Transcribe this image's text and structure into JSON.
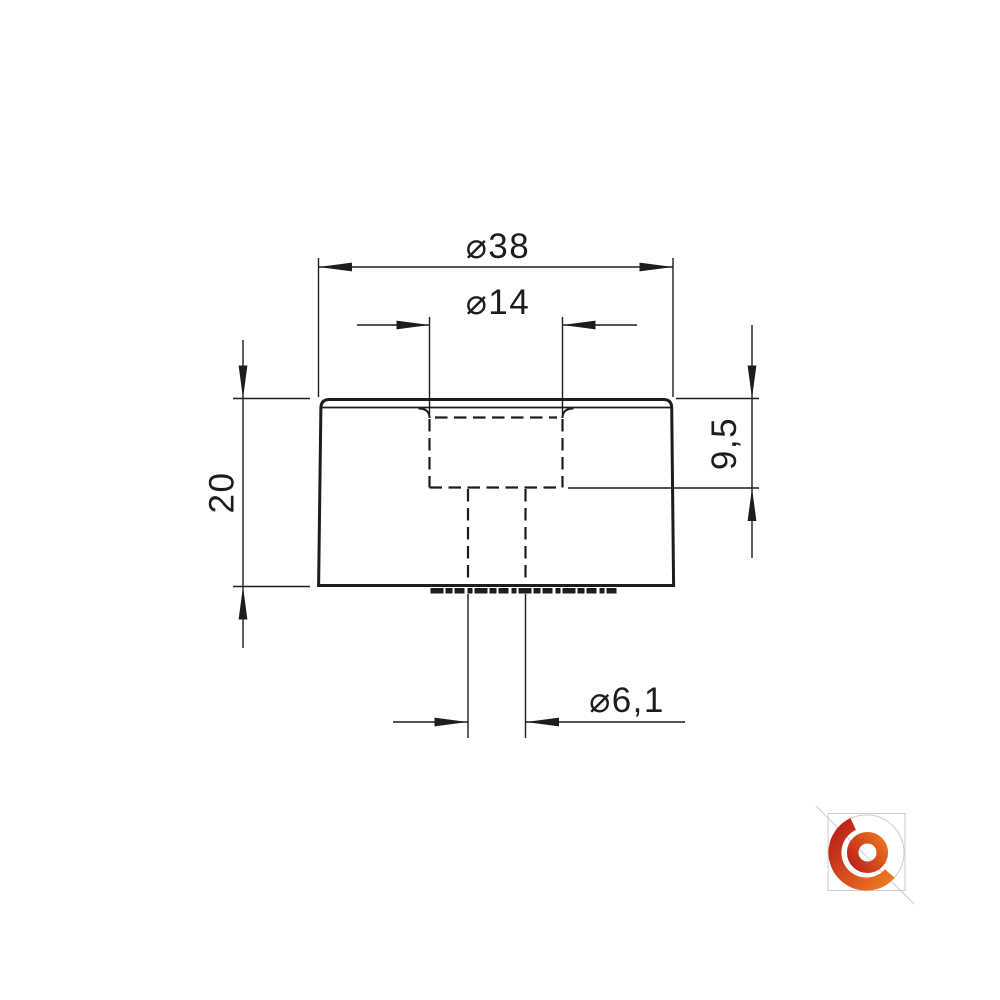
{
  "drawing": {
    "line_color": "#1d1d1d",
    "dim_outer_diameter": "⌀38",
    "dim_insert_diameter": "⌀14",
    "dim_height": "20",
    "dim_insert_depth": "9,5",
    "dim_hole_diameter": "⌀6,1"
  },
  "logo": {
    "guide_color": "#cbccd2",
    "gradient_red": "#b9191b",
    "gradient_orange": "#f18121"
  }
}
